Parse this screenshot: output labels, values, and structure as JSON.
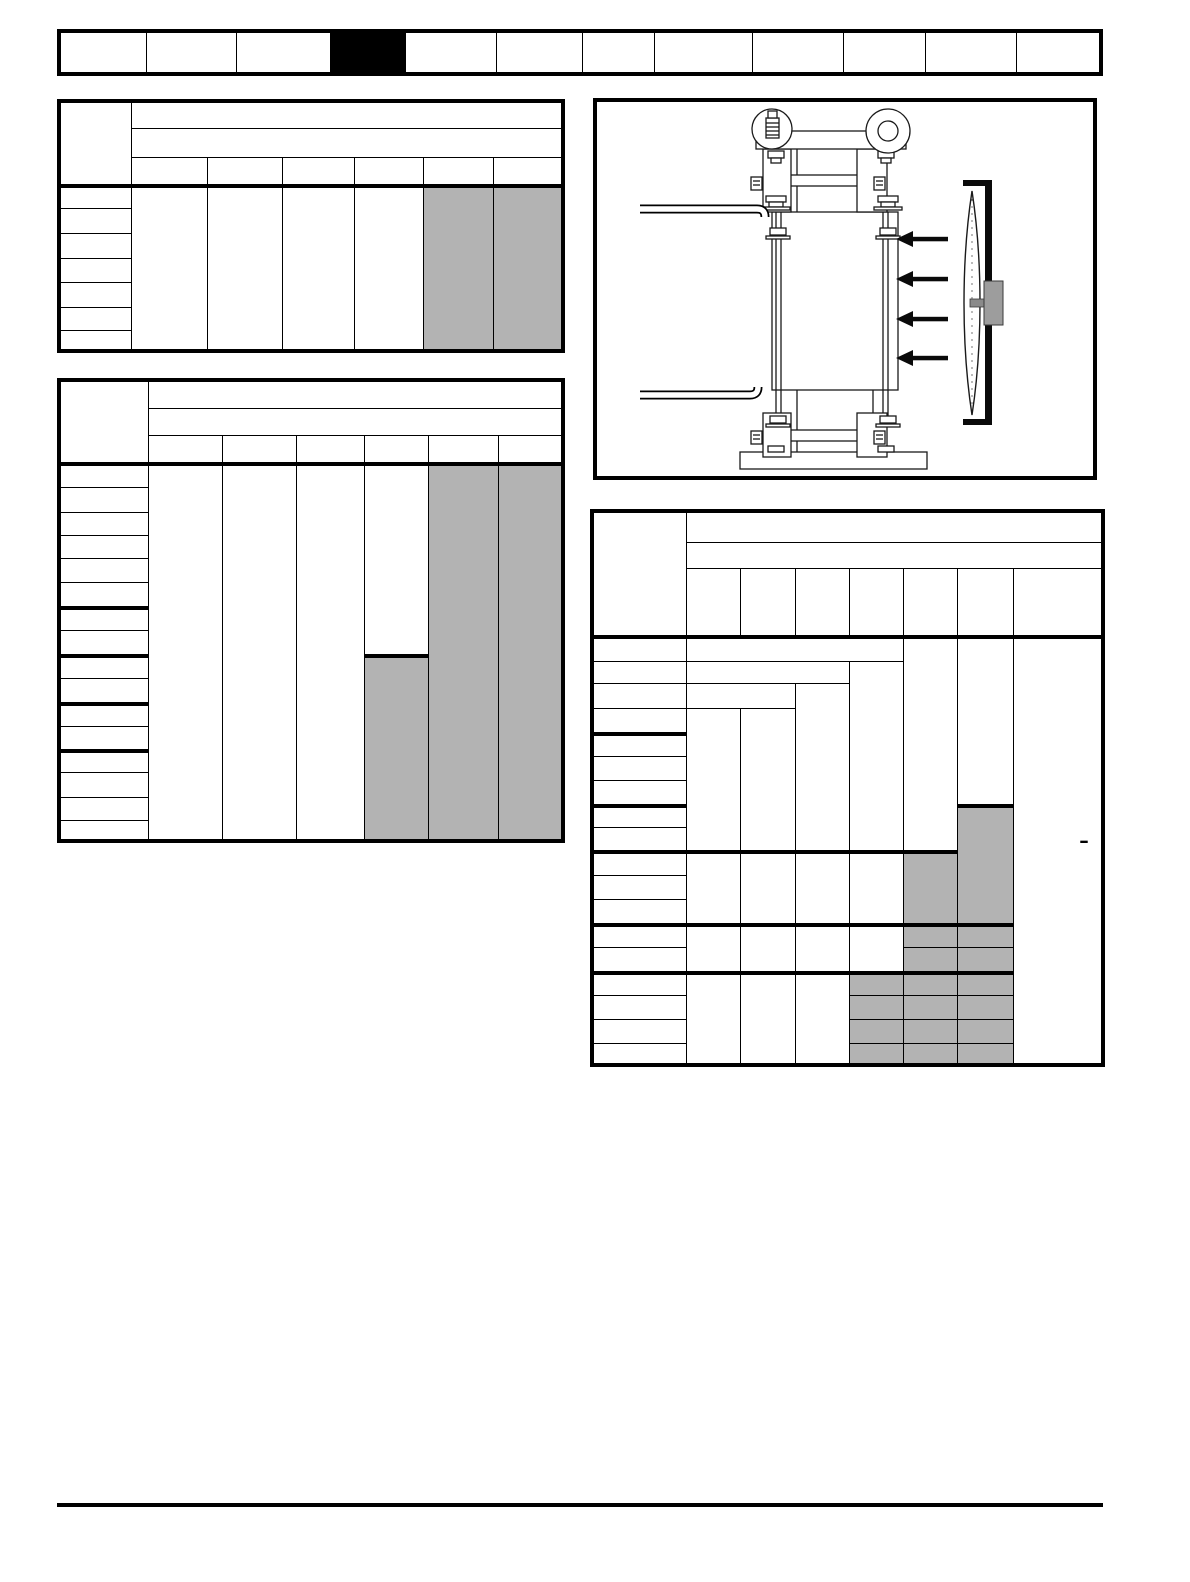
{
  "page": {
    "bg": "#ffffff",
    "ink": "#000000",
    "gray": "#b3b3b3"
  },
  "nav": {
    "rect": [
      57,
      29,
      1046,
      47
    ],
    "cell_edges": [
      57,
      146,
      236,
      330,
      405,
      496,
      582,
      654,
      752,
      843,
      925,
      1016,
      1103
    ],
    "active_index": 3
  },
  "footer_rule": [
    57,
    1503,
    1046,
    4
  ],
  "diagram": {
    "rect": [
      593,
      98,
      504,
      382
    ]
  },
  "tables": [
    {
      "name": "spec-table-top-left",
      "rect": [
        57,
        99,
        508,
        254
      ],
      "gray": [
        [
          423,
          184,
          70,
          167
        ],
        [
          493,
          184,
          70,
          167
        ]
      ],
      "vlines": [
        [
          131,
          103,
          351
        ],
        [
          207,
          157,
          351
        ],
        [
          282,
          157,
          351
        ],
        [
          354,
          157,
          351
        ],
        [
          423,
          157,
          351
        ],
        [
          493,
          157,
          351
        ]
      ],
      "hlines": [
        [
          128,
          131,
          563
        ],
        [
          157,
          131,
          563
        ],
        [
          184,
          59,
          563,
          3.5
        ],
        [
          208,
          59,
          131
        ],
        [
          233,
          59,
          131
        ],
        [
          258,
          59,
          131
        ],
        [
          282,
          59,
          131
        ],
        [
          307,
          59,
          131
        ],
        [
          330,
          59,
          131
        ]
      ]
    },
    {
      "name": "spec-table-left",
      "rect": [
        57,
        378,
        508,
        465
      ],
      "gray": [
        [
          428,
          462,
          70,
          379
        ],
        [
          498,
          462,
          65,
          379
        ],
        [
          364,
          654,
          64,
          187
        ]
      ],
      "vlines": [
        [
          148,
          382,
          841
        ],
        [
          222,
          435,
          841
        ],
        [
          296,
          435,
          841
        ],
        [
          364,
          435,
          841
        ],
        [
          428,
          435,
          841
        ],
        [
          498,
          435,
          841
        ]
      ],
      "hlines": [
        [
          408,
          148,
          563
        ],
        [
          435,
          148,
          563
        ],
        [
          462,
          59,
          563,
          3.5
        ],
        [
          487,
          59,
          148
        ],
        [
          512,
          59,
          148
        ],
        [
          535,
          59,
          148
        ],
        [
          558,
          59,
          148
        ],
        [
          582,
          59,
          148
        ],
        [
          606,
          59,
          148,
          3.5
        ],
        [
          630,
          59,
          148
        ],
        [
          654,
          59,
          148,
          3.5
        ],
        [
          678,
          59,
          148
        ],
        [
          702,
          59,
          148,
          3.5
        ],
        [
          726,
          59,
          148
        ],
        [
          749,
          59,
          148,
          3.5
        ],
        [
          772,
          59,
          148
        ],
        [
          797,
          59,
          148
        ],
        [
          820,
          59,
          148
        ],
        [
          654,
          364,
          428,
          3.5
        ]
      ]
    },
    {
      "name": "spec-table-right",
      "rect": [
        590,
        509,
        515,
        558
      ],
      "dash": "–",
      "gray": [
        [
          957,
          804,
          56,
          259
        ],
        [
          903,
          850,
          54,
          213
        ],
        [
          849,
          971,
          54,
          92
        ]
      ],
      "vlines": [
        [
          686,
          513,
          1063
        ],
        [
          740,
          568,
          635
        ],
        [
          740,
          708,
          1063
        ],
        [
          795,
          568,
          635
        ],
        [
          795,
          683,
          1063
        ],
        [
          849,
          568,
          635
        ],
        [
          849,
          661,
          1063
        ],
        [
          903,
          568,
          1063
        ],
        [
          957,
          568,
          1063
        ],
        [
          1013,
          568,
          1063
        ]
      ],
      "hlines": [
        [
          542,
          686,
          1101
        ],
        [
          568,
          686,
          1101
        ],
        [
          635,
          594,
          1101,
          3.5
        ],
        [
          661,
          594,
          903
        ],
        [
          683,
          594,
          849
        ],
        [
          708,
          594,
          795
        ],
        [
          732,
          594,
          686,
          3.5
        ],
        [
          756,
          594,
          686
        ],
        [
          780,
          594,
          686
        ],
        [
          804,
          594,
          686,
          3.5
        ],
        [
          804,
          957,
          1013,
          3.5
        ],
        [
          827,
          594,
          686
        ],
        [
          850,
          594,
          957,
          3.5
        ],
        [
          875,
          594,
          686
        ],
        [
          899,
          594,
          686
        ],
        [
          923,
          594,
          1013,
          3.5
        ],
        [
          947,
          594,
          686
        ],
        [
          947,
          903,
          1013
        ],
        [
          971,
          594,
          1013,
          3.5
        ],
        [
          995,
          594,
          686
        ],
        [
          995,
          849,
          1013
        ],
        [
          1019,
          594,
          686
        ],
        [
          1019,
          849,
          1013
        ],
        [
          1043,
          594,
          686
        ],
        [
          1043,
          849,
          1013
        ]
      ]
    }
  ]
}
